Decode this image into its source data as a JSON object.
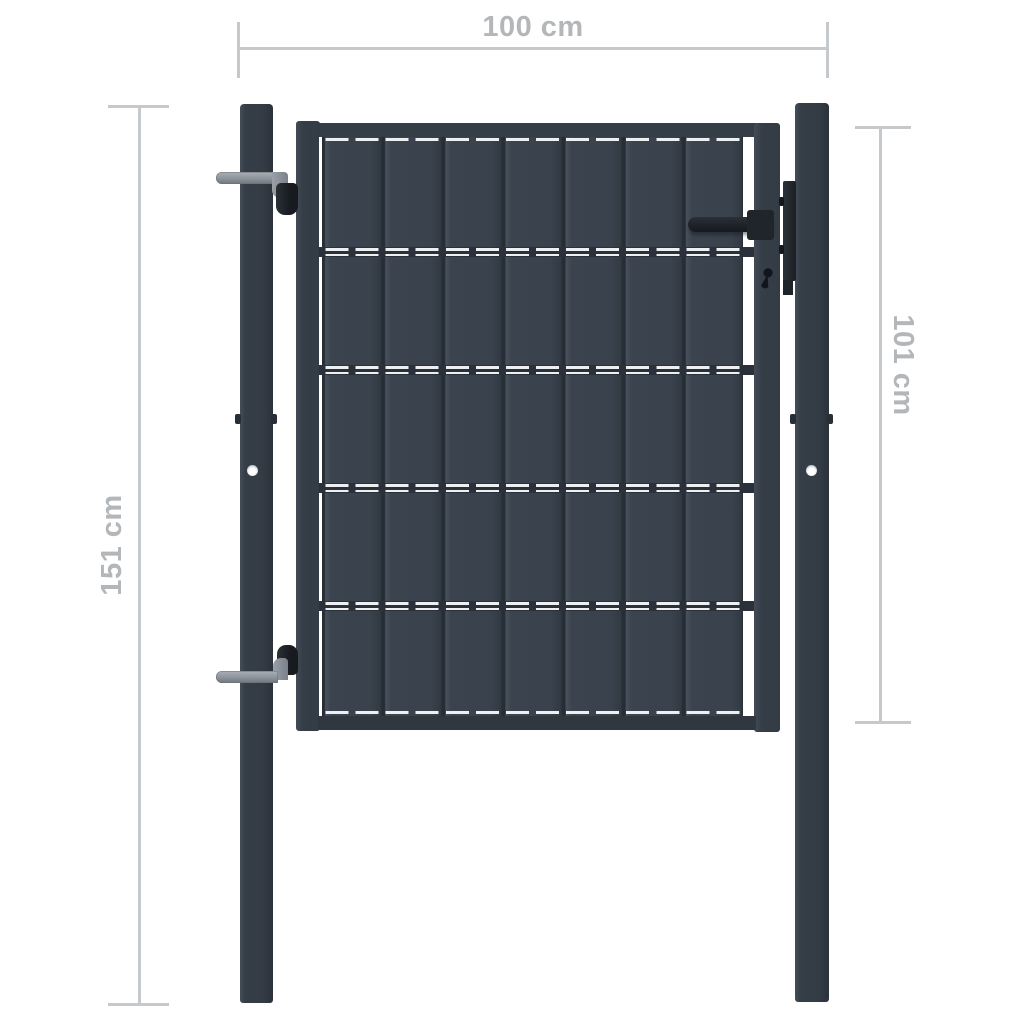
{
  "image": {
    "title": "Fence gate dimension diagram"
  },
  "dimensions": {
    "top": {
      "label": "100 cm"
    },
    "left": {
      "label": "151 cm"
    },
    "right": {
      "label": "101 cm"
    }
  },
  "gate": {
    "slat_rows": 5,
    "slat_columns": 7,
    "hardware": [
      "upper-hinge",
      "lower-hinge",
      "handle",
      "latch-plate",
      "keyhole"
    ]
  },
  "colors": {
    "background": "#ffffff",
    "anthracite": "#353d47",
    "slat": "#3a424d",
    "slat_gap": "#262d35",
    "wire_white": "#edeff1",
    "metal_gray": "#8d939a",
    "hardware_black": "#1d2127",
    "dimension_line": "#c6c9cb",
    "dimension_text": "#b4b7ba"
  }
}
